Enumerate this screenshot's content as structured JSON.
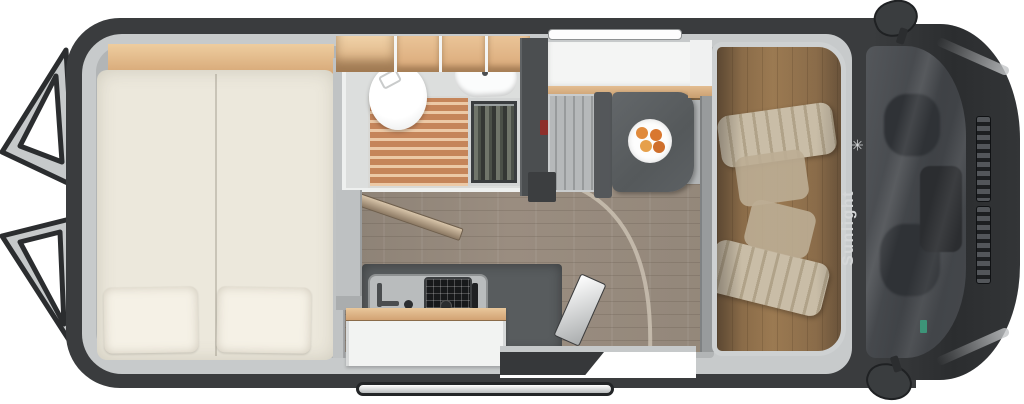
{
  "meta": {
    "type": "camper-van-floor-plan",
    "view": "top-down-cutaway"
  },
  "brand": {
    "label": "Sunlight",
    "logo_glyph": "✳"
  },
  "areas": {
    "rear_doors": "open-rear-barn-doors",
    "bed": "transverse-double-bed-with-two-pillows",
    "overhead_shelf": "wood-overhead-locker-strip",
    "bathroom": "wet-room-toilet-shower-sink",
    "wardrobe": "hanging-wardrobe",
    "kitchen": "kitchenette-sink-and-two-burner-hob",
    "dinette": "bench-seat-with-table",
    "table_item": "plate-of-fruit",
    "entry": "open-sliding-door-with-exterior-step",
    "cab": "cab-with-two-swivel-seats",
    "front": "windshield-dashboard-and-hood"
  },
  "colors": {
    "body_dark": "#3a3c3e",
    "rim_silver": "#c7cacb",
    "interior_gray": "#b2b5b6",
    "mattress_cream": "#ece8dc",
    "wood_locker": "#d7a877",
    "shower_slats": "#c5855a",
    "floor_wood": "#948a7d",
    "cab_floor_wood": "#a8805a",
    "counter_gray": "#585c5e",
    "seat_beige": "#e8dcc4",
    "accent_red": "#8d2f2a",
    "brand_text": "#d5d7d8"
  }
}
